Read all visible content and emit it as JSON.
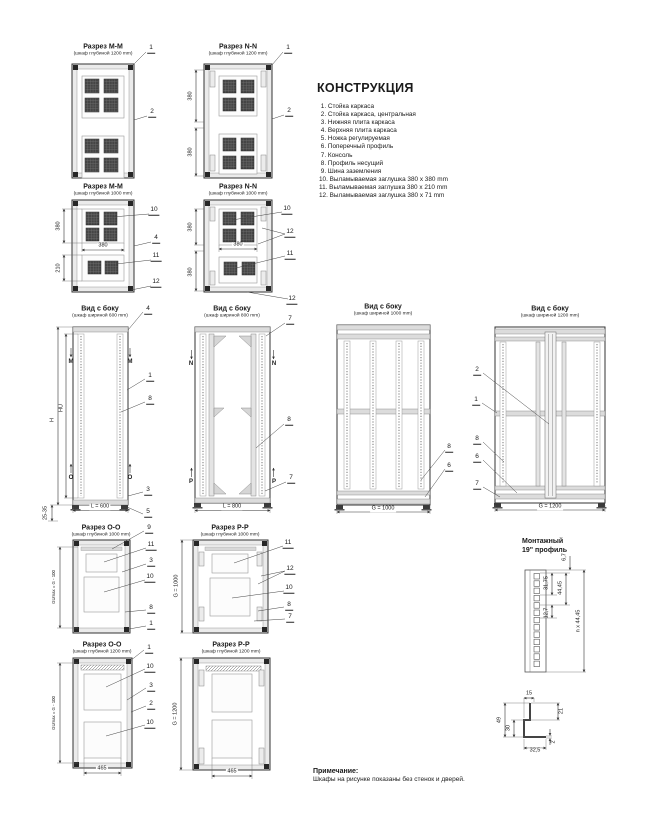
{
  "construction": {
    "title": "КОНСТРУКЦИЯ",
    "items": [
      " 1. Стойка каркаса",
      " 2. Стойка каркаса, центральная",
      " 3. Нижняя плита каркаса",
      " 4. Верхняя плита каркаса",
      " 5. Ножка регулируемая",
      " 6. Поперечный профиль",
      " 7. Консоль",
      " 8. Профиль несущий",
      " 9. Шина заземления",
      "10. Выламываемая заглушка 380 x 380 mm",
      "11. Выламываемая заглушка 380 x 210 mm",
      "12. Выламываемая заглушка 380 x 71 mm"
    ]
  },
  "note": {
    "title": "Примечание:",
    "body": "Шкафы на рисунке показаны без стенок и дверей."
  },
  "sections": {
    "mm1200": {
      "title": "Разрез М-М",
      "subtitle": "(шкаф глубиной 1200 mm)",
      "callouts": [
        "1",
        "2"
      ]
    },
    "nn1200": {
      "title": "Разрез N-N",
      "subtitle": "(шкаф глубиной 1200 mm)",
      "dims": [
        "380",
        "380"
      ],
      "callouts": [
        "1",
        "2"
      ]
    },
    "mm1000": {
      "title": "Разрез М-М",
      "subtitle": "(шкаф глубиной 1000 mm)",
      "dims": [
        "380",
        "210",
        "380"
      ],
      "callouts": [
        "10",
        "4",
        "11",
        "12"
      ]
    },
    "nn1000": {
      "title": "Разрез N-N",
      "subtitle": "(шкаф глубиной 1000 mm)",
      "dims": [
        "380",
        "380",
        "380"
      ],
      "callouts": [
        "10",
        "12",
        "11",
        "12"
      ]
    },
    "side600": {
      "title": "Вид с боку",
      "subtitle": "(шкаф шириной 600 mm)",
      "dims": [
        "H",
        "HU",
        "L = 600",
        "25-35"
      ],
      "markers": [
        "M",
        "M",
        "O",
        "O"
      ],
      "callouts": [
        "4",
        "1",
        "8",
        "3",
        "5"
      ]
    },
    "side800": {
      "title": "Вид с боку",
      "subtitle": "(шкаф шириной 800 mm)",
      "dims": [
        "L = 800"
      ],
      "markers": [
        "N",
        "N",
        "P",
        "P"
      ],
      "callouts": [
        "7",
        "8",
        "7"
      ]
    },
    "side1000": {
      "title": "Вид с боку",
      "subtitle": "(шкаф шириной 1000 mm)",
      "dims": [
        "G = 1000"
      ],
      "callouts": [
        "8",
        "6"
      ]
    },
    "side1200": {
      "title": "Вид с боку",
      "subtitle": "(шкаф шириной 1200 mm)",
      "dims": [
        "G = 1200"
      ],
      "callouts": [
        "2",
        "1",
        "8",
        "6",
        "7"
      ]
    },
    "oo1000": {
      "title": "Разрез О-О",
      "subtitle": "(шкаф глубиной 1000 mm)",
      "dims": [
        "GUmax = G - 100"
      ],
      "callouts": [
        "9",
        "11",
        "3",
        "10",
        "8",
        "1"
      ]
    },
    "pp1000": {
      "title": "Разрез Р-Р",
      "subtitle": "(шкаф глубиной 1000 mm)",
      "dims": [
        "G = 1000"
      ],
      "callouts": [
        "11",
        "12",
        "10",
        "8",
        "7"
      ]
    },
    "oo1200": {
      "title": "Разрез О-О",
      "subtitle": "(шкаф глубиной 1200 mm)",
      "dims": [
        "GUmax = G - 100",
        "465"
      ],
      "callouts": [
        "1",
        "10",
        "3",
        "2",
        "10"
      ]
    },
    "pp1200": {
      "title": "Разрез Р-Р",
      "subtitle": "(шкаф глубиной 1200 mm)",
      "dims": [
        "G = 1200",
        "465"
      ]
    },
    "rail": {
      "title_line1": "Монтажный",
      "title_line2": "19\" профиль",
      "dims": [
        "6,7",
        "31,75",
        "44,45",
        "12,7",
        "n x 44,45"
      ]
    },
    "bracket": {
      "dims": [
        "15",
        "21",
        "49",
        "30",
        "2",
        "32,5"
      ]
    }
  }
}
